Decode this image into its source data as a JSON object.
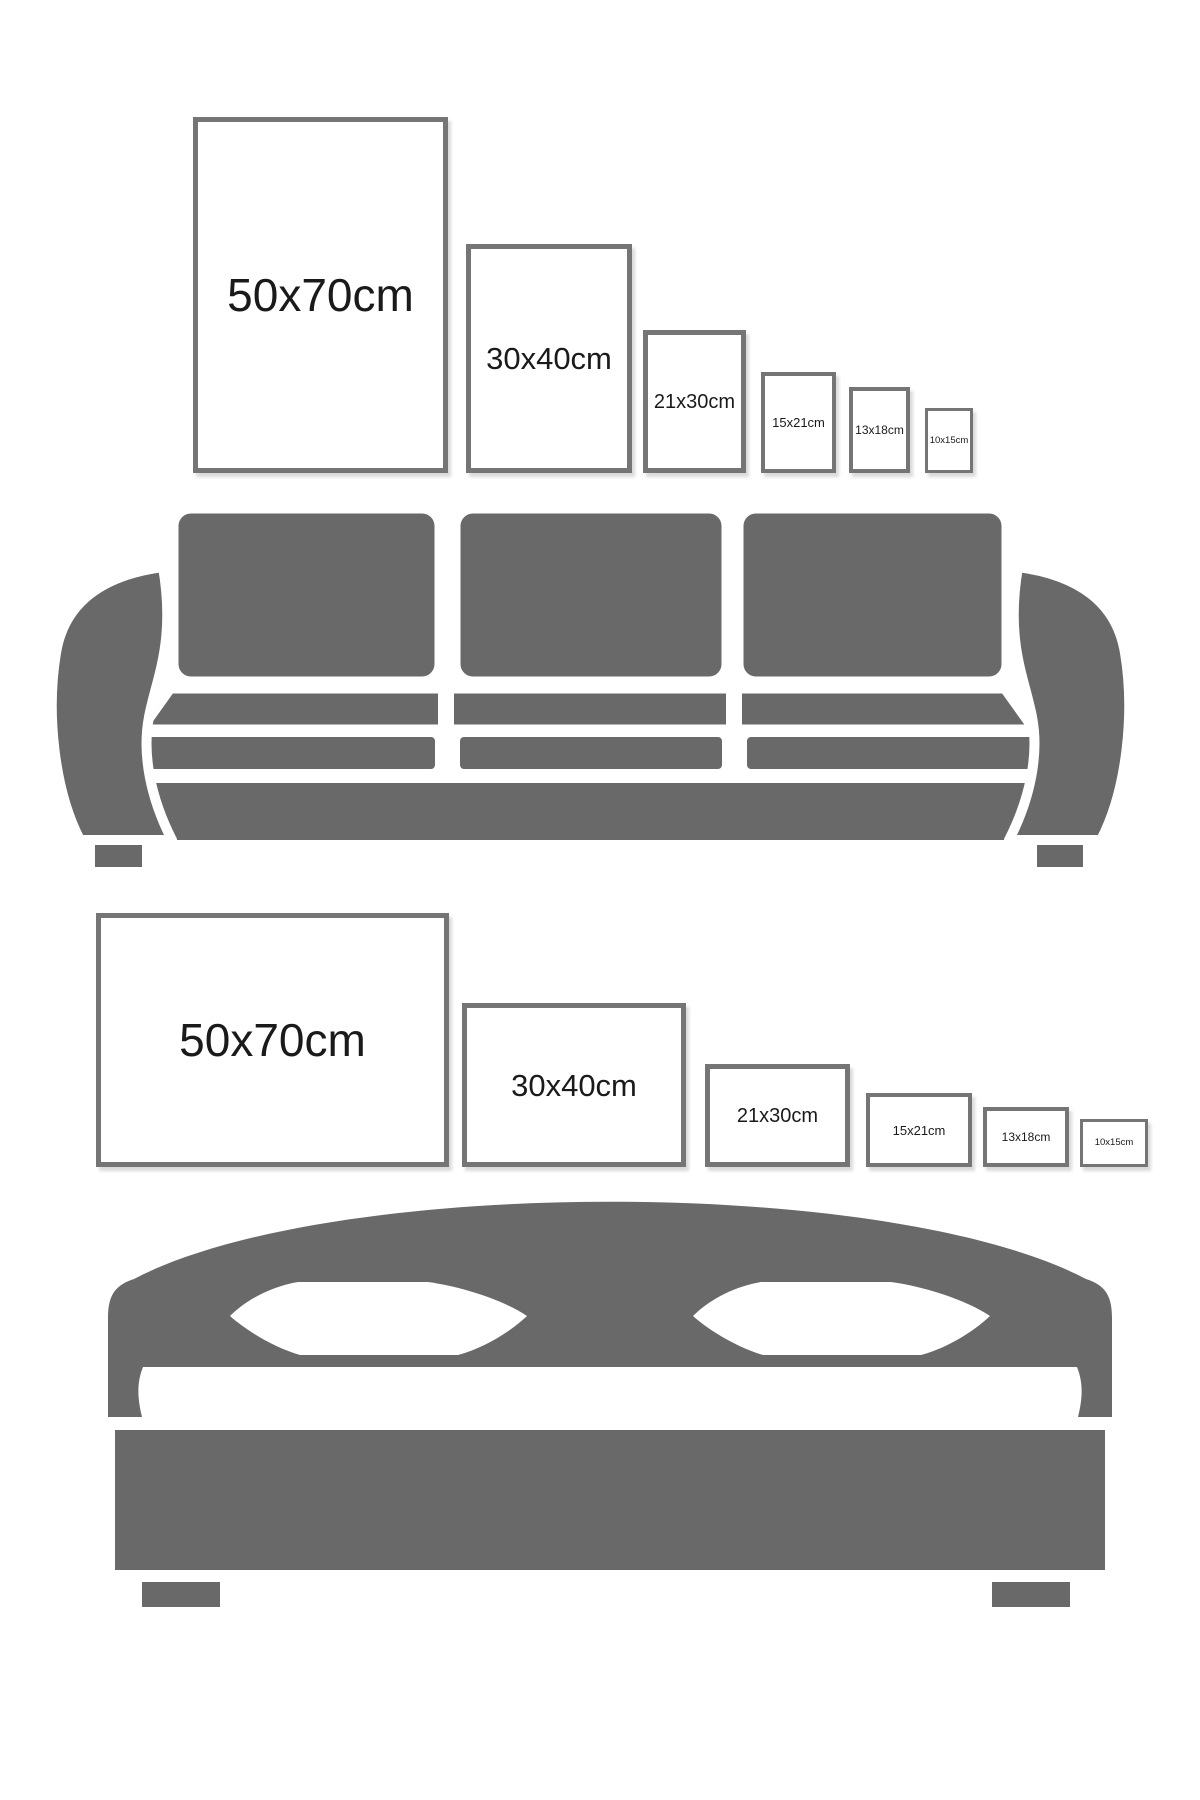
{
  "colors": {
    "background": "#ffffff",
    "furniture_gray": "#696969",
    "frame_border": "#757575",
    "label_text": "#1a1a1a"
  },
  "sofa_section": {
    "furniture": "sofa",
    "frame_orientation": "portrait",
    "frames": [
      {
        "label": "50x70cm"
      },
      {
        "label": "30x40cm"
      },
      {
        "label": "21x30cm"
      },
      {
        "label": "15x21cm"
      },
      {
        "label": "13x18cm"
      },
      {
        "label": "10x15cm"
      }
    ]
  },
  "bed_section": {
    "furniture": "bed",
    "frame_orientation": "landscape",
    "frames": [
      {
        "label": "50x70cm"
      },
      {
        "label": "30x40cm"
      },
      {
        "label": "21x30cm"
      },
      {
        "label": "15x21cm"
      },
      {
        "label": "13x18cm"
      },
      {
        "label": "10x15cm"
      }
    ]
  }
}
